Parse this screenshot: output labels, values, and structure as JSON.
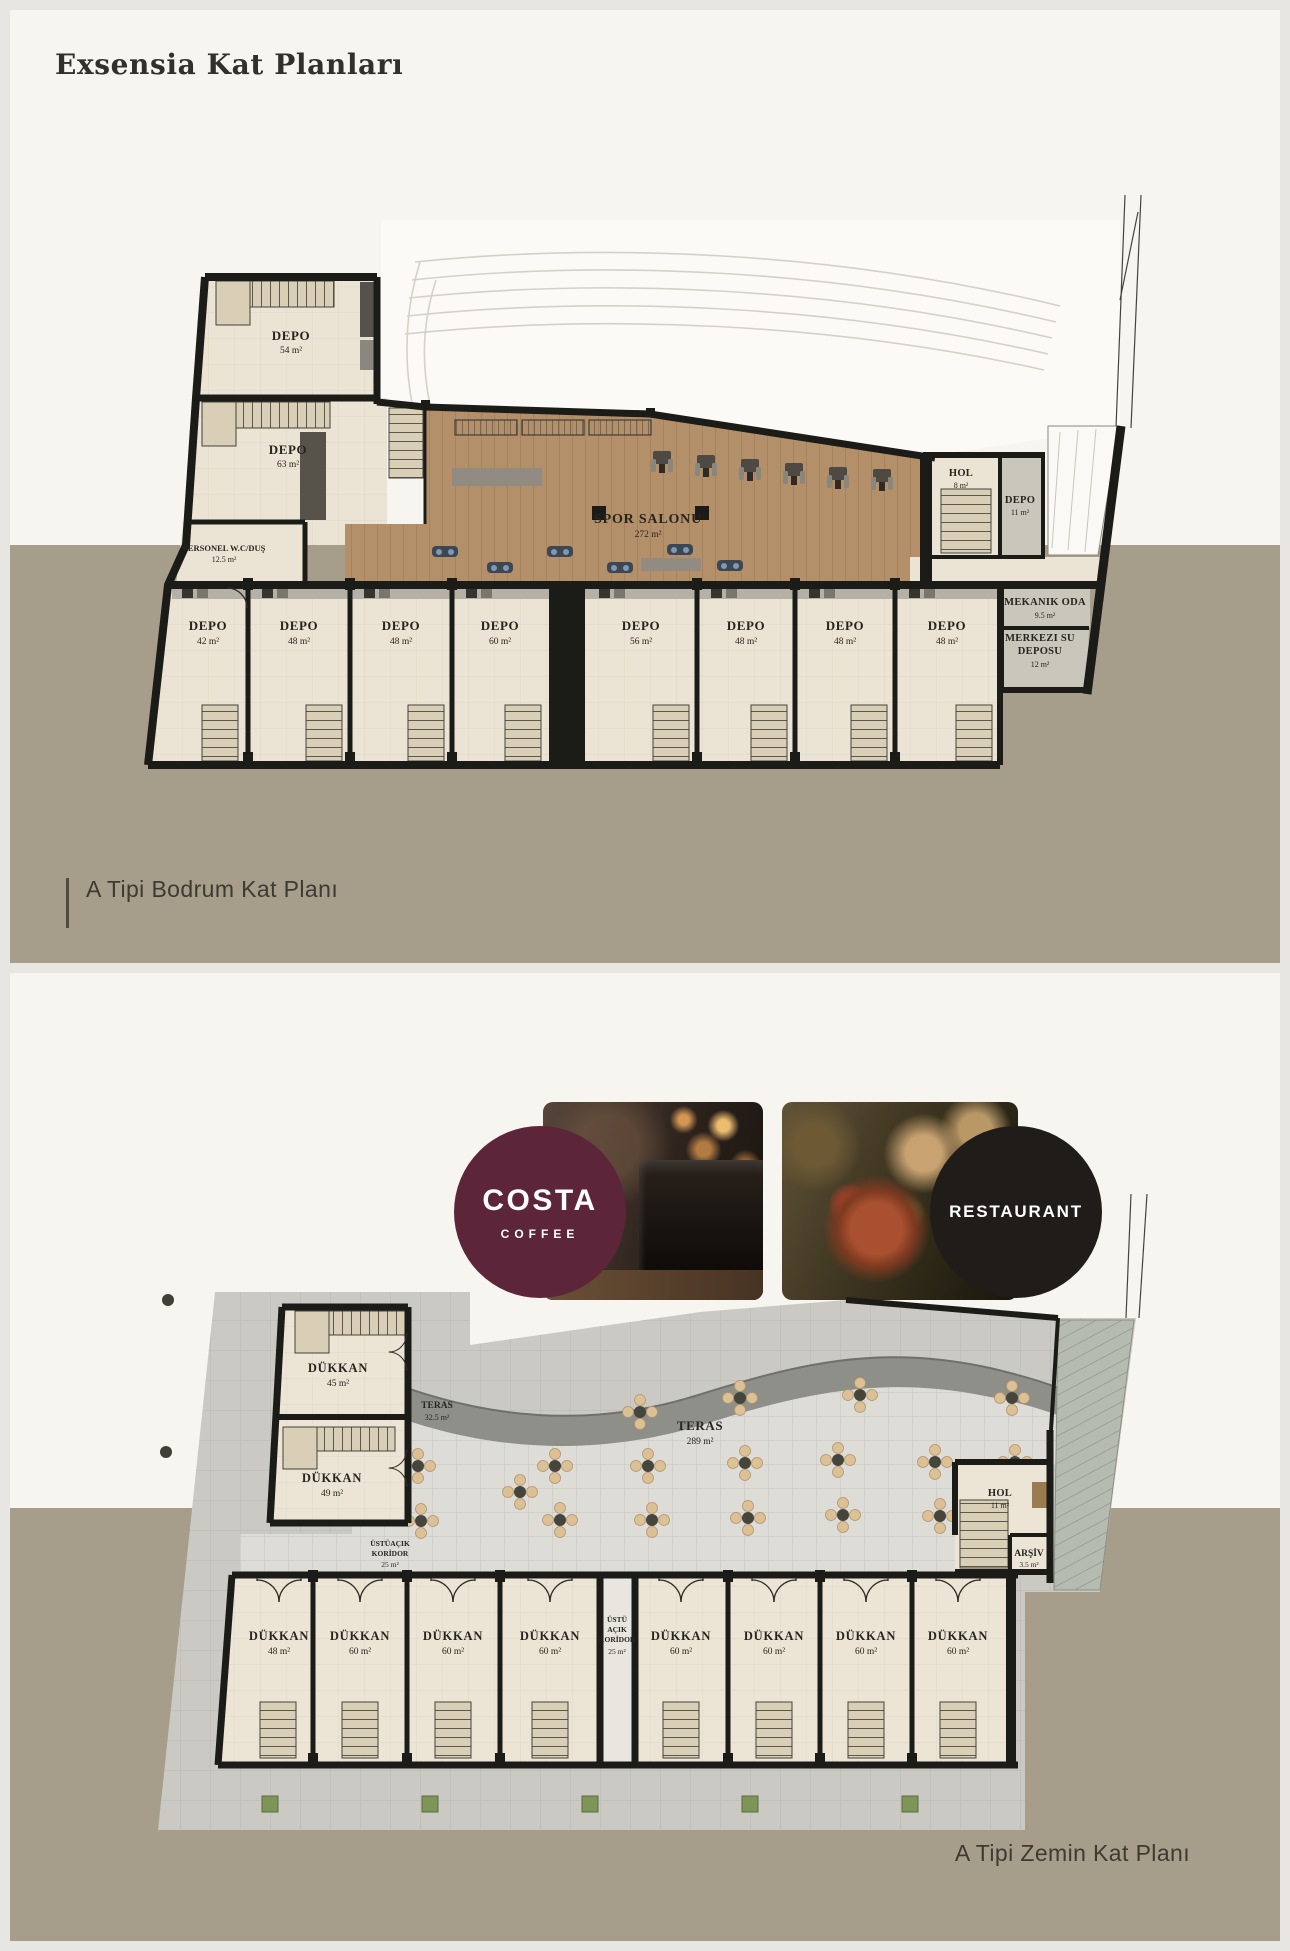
{
  "page": {
    "title": "Exsensia Kat Planları"
  },
  "captions": {
    "basement": "A Tipi Bodrum Kat Planı",
    "ground": "A Tipi Zemin Kat Planı"
  },
  "logos": {
    "costa": {
      "name": "COSTA",
      "sub": "COFFEE",
      "color": "#5d2539"
    },
    "restaurant": {
      "name": "RESTAURANT",
      "color": "#201c19"
    }
  },
  "colors": {
    "page_bg": "#e8e6e2",
    "panel": "#f7f5ef",
    "ground": "#a79d8b",
    "wood": "#b3906a",
    "room": "#ebe4d4",
    "wall": "#1b1b18",
    "terrace": "#dedcd6",
    "pavement": "#cac9c3",
    "band": "#8f8f8a",
    "costa": "#5d2539",
    "restaurant": "#201c19",
    "chair": "#dcc096",
    "table": "#45453b"
  },
  "basement": {
    "depo54": {
      "name": "DEPO",
      "area": "54 m²"
    },
    "depo63": {
      "name": "DEPO",
      "area": "63 m²"
    },
    "wc": {
      "name": "PERSONEL W.C/DUŞ",
      "area": "12.5 m²"
    },
    "gym": {
      "name": "SPOR SALONU",
      "area": "272 m²"
    },
    "hol": {
      "name": "HOL",
      "area": "8 m²"
    },
    "depo11": {
      "name": "DEPO",
      "area": "11 m²"
    },
    "mekanik": {
      "name": "MEKANIK ODA",
      "area": "9.5 m²"
    },
    "merkezi": {
      "line1": "MERKEZI SU",
      "line2": "DEPOSU",
      "area": "12 m²"
    },
    "storage": [
      {
        "name": "DEPO",
        "area": "42 m²"
      },
      {
        "name": "DEPO",
        "area": "48 m²"
      },
      {
        "name": "DEPO",
        "area": "48 m²"
      },
      {
        "name": "DEPO",
        "area": "60 m²"
      },
      {
        "name": "DEPO",
        "area": "56 m²"
      },
      {
        "name": "DEPO",
        "area": "48 m²"
      },
      {
        "name": "DEPO",
        "area": "48 m²"
      },
      {
        "name": "DEPO",
        "area": "48 m²"
      }
    ]
  },
  "ground": {
    "dukkan45": {
      "name": "DÜKKAN",
      "area": "45 m²"
    },
    "dukkan49": {
      "name": "DÜKKAN",
      "area": "49 m²"
    },
    "teras_small": {
      "name": "TERAS",
      "area": "32.5 m²"
    },
    "teras": {
      "name": "TERAS",
      "area": "289 m²"
    },
    "hol": {
      "name": "HOL",
      "area": "11 m²"
    },
    "arsiv": {
      "name": "ARŞİV",
      "area": "3.5 m²"
    },
    "koridor": {
      "line1": "ÜSTÜAÇIK",
      "line2": "KORİDOR",
      "area": "25 m²"
    },
    "koridor_dikey": {
      "line1": "ÜSTÜ",
      "line2": "AÇIK",
      "line3": "KORİDOR",
      "area": "25 m²"
    },
    "shops": [
      {
        "name": "DÜKKAN",
        "area": "48 m²"
      },
      {
        "name": "DÜKKAN",
        "area": "60 m²"
      },
      {
        "name": "DÜKKAN",
        "area": "60 m²"
      },
      {
        "name": "DÜKKAN",
        "area": "60 m²"
      },
      {
        "name": "DÜKKAN",
        "area": "60 m²"
      },
      {
        "name": "DÜKKAN",
        "area": "60 m²"
      },
      {
        "name": "DÜKKAN",
        "area": "60 m²"
      },
      {
        "name": "DÜKKAN",
        "area": "60 m²"
      }
    ]
  }
}
